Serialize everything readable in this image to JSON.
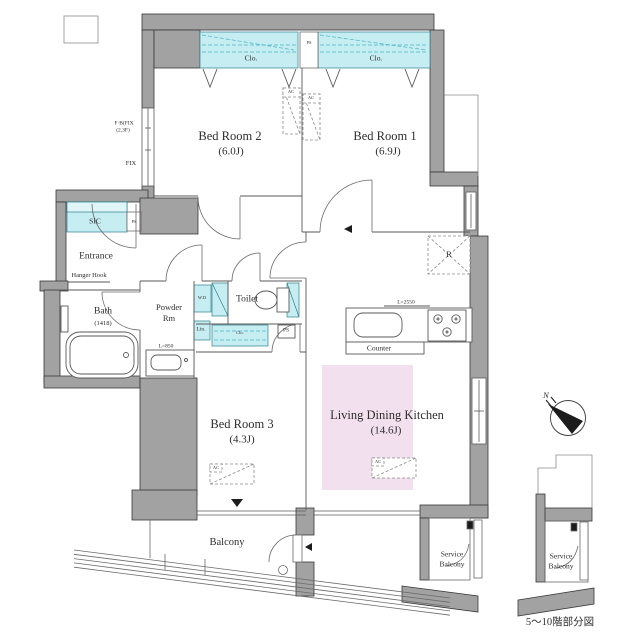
{
  "caption": "5〜10階部分図",
  "compass": {
    "north_label": "N"
  },
  "rooms": {
    "bedroom1": {
      "name": "Bed Room 1",
      "size": "(6.9J)"
    },
    "bedroom2": {
      "name": "Bed Room 2",
      "size": "(6.0J)"
    },
    "bedroom3": {
      "name": "Bed Room 3",
      "size": "(4.3J)"
    },
    "ldk": {
      "name": "Living Dining Kitchen",
      "size": "(14.6J)"
    },
    "entrance": {
      "name": "Entrance",
      "note": "Hanger Hook"
    },
    "bath": {
      "name": "Bath",
      "size": "(1418)"
    },
    "powder_room": {
      "line1": "Powder",
      "line2": "Rm"
    },
    "toilet": {
      "name": "Toilet"
    },
    "sic": {
      "name": "SIC"
    },
    "balcony": {
      "name": "Balcony"
    },
    "service_balcony": {
      "line1": "Service",
      "line2": "Balcony"
    }
  },
  "labels": {
    "closet": "Clo.",
    "pipe_space": "PS",
    "air_con": "AC",
    "washer_dryer": "W.D",
    "linen": "Lin.",
    "refrigerator": "R",
    "counter": "Counter",
    "fix_window": "FIX",
    "fix_note_line1": "F·B(FIX",
    "fix_note_line2": "(2,3F)",
    "kitchen_length": "L=2550",
    "basin_length": "L=850"
  },
  "colors": {
    "wall": "#a2a2a2",
    "closet_fill": "#c6edf2",
    "closet_accent": "#45b4c2",
    "ldk_highlight": "#f3e0ee",
    "line": "#5a5a5a"
  }
}
